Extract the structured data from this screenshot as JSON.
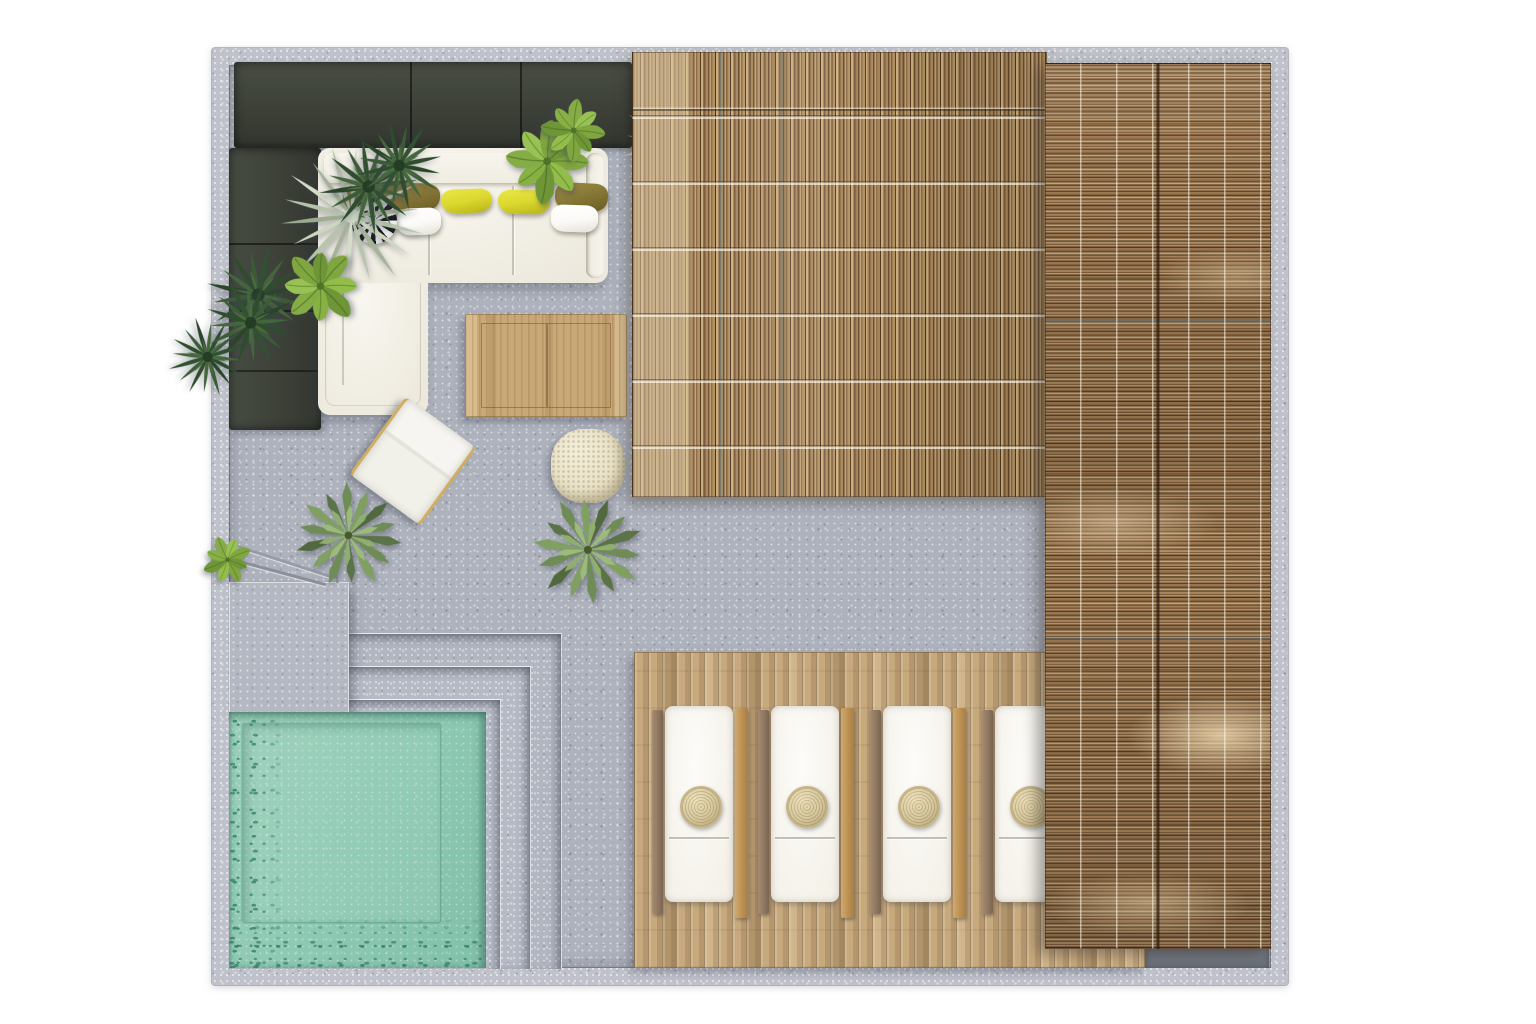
{
  "meta": {
    "type": "architectural-plan-render",
    "view": "top-down",
    "canvas": {
      "width": 1536,
      "height": 1024
    }
  },
  "colors": {
    "wall": "#bfc2ca",
    "floor": "#aeb2bd",
    "planter": "#3e4339",
    "pool-water": "#93ccb6",
    "pool-deep": "#2e8169",
    "deck-wood": "#c7a97e",
    "thatch-top": "#a0825a",
    "thatch-right": "#937550",
    "table-wood": "#c9a877",
    "sofa-fabric": "#f4f1e8",
    "pillow-olive": "#8a7a38",
    "pillow-yellow": "#dcd830",
    "pillow-white": "#fbfaf7",
    "pouf": "#e9e1c6",
    "rattan": "#d6c79c",
    "gold": "#cfae62",
    "leaf-dark": "#2f4d2d",
    "leaf-mid": "#4d6b42",
    "leaf-bright": "#85ac45",
    "leaf-silver": "#b7c4ac",
    "agave-green": "#6f8c57",
    "shadow-strip": "#70757e"
  },
  "scene": {
    "wall": {
      "label": "perimeter-wall"
    },
    "floor": {
      "label": "terrazzo-floor"
    },
    "planters": {
      "count": 2
    },
    "plants": {
      "silver_fan_palms": 2,
      "dark_palms": 5,
      "broadleaf_shrubs": 4,
      "agaves": 2
    },
    "lounge": {
      "sofa": {
        "shape": "L-sectional",
        "pillows": {
          "olive": 3,
          "yellow": 2,
          "white": 2,
          "striped": 1
        }
      },
      "coffee_table": 1,
      "armchair": 1,
      "pouf": 1
    },
    "pool": {
      "shape": "square",
      "steps": 3,
      "platform": 1,
      "railing": 1
    },
    "deck": {
      "loungers": {
        "count": 4,
        "x_lefts": [
          440,
          546,
          658,
          770
        ],
        "pillow": "round-rattan"
      }
    },
    "canopies": {
      "top": "reed-mat-vertical",
      "right": "reed-mat-horizontal"
    }
  }
}
